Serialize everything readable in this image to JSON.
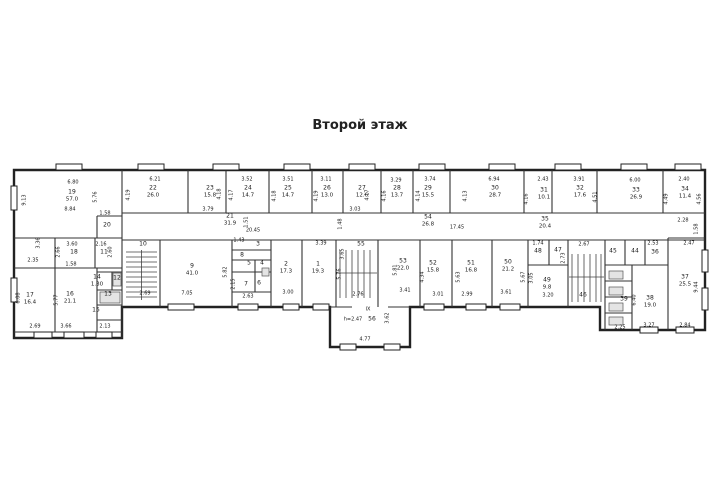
{
  "title": "Второй этаж",
  "plan": {
    "rooms": [
      {
        "id": "19",
        "area": "57.0",
        "x": 72,
        "y": 196
      },
      {
        "id": "20",
        "x": 107,
        "y": 226
      },
      {
        "id": "22",
        "area": "26.0",
        "x": 153,
        "y": 192
      },
      {
        "id": "23",
        "area": "15.8",
        "x": 210,
        "y": 192
      },
      {
        "id": "24",
        "area": "14.7",
        "x": 248,
        "y": 192
      },
      {
        "id": "25",
        "area": "14.7",
        "x": 288,
        "y": 192
      },
      {
        "id": "26",
        "area": "13.0",
        "x": 327,
        "y": 192
      },
      {
        "id": "27",
        "area": "12.6",
        "x": 362,
        "y": 192
      },
      {
        "id": "28",
        "area": "13.7",
        "x": 397,
        "y": 192
      },
      {
        "id": "29",
        "area": "15.5",
        "x": 428,
        "y": 192
      },
      {
        "id": "30",
        "area": "28.7",
        "x": 495,
        "y": 192
      },
      {
        "id": "31",
        "area": "10.1",
        "x": 544,
        "y": 194
      },
      {
        "id": "32",
        "area": "17.6",
        "x": 580,
        "y": 192
      },
      {
        "id": "33",
        "area": "26.9",
        "x": 636,
        "y": 194
      },
      {
        "id": "34",
        "area": "11.4",
        "x": 685,
        "y": 193
      },
      {
        "id": "21",
        "area": "31.9",
        "x": 230,
        "y": 220
      },
      {
        "id": "54",
        "area": "26.8",
        "x": 428,
        "y": 221
      },
      {
        "id": "35",
        "area": "20.4",
        "x": 545,
        "y": 223
      },
      {
        "id": "18",
        "x": 74,
        "y": 253
      },
      {
        "id": "11",
        "x": 104,
        "y": 253
      },
      {
        "id": "17",
        "area": "16.4",
        "x": 30,
        "y": 299
      },
      {
        "id": "16",
        "area": "21.1",
        "x": 70,
        "y": 298
      },
      {
        "id": "14",
        "area": "1.30",
        "x": 97,
        "y": 281
      },
      {
        "id": "12",
        "x": 117,
        "y": 279
      },
      {
        "id": "13",
        "x": 108,
        "y": 295
      },
      {
        "id": "15",
        "x": 96,
        "y": 311
      },
      {
        "id": "10",
        "x": 143,
        "y": 245
      },
      {
        "id": "9",
        "area": "41.0",
        "x": 192,
        "y": 270
      },
      {
        "id": "3",
        "x": 258,
        "y": 245
      },
      {
        "id": "8",
        "x": 242,
        "y": 256
      },
      {
        "id": "5",
        "x": 249,
        "y": 264
      },
      {
        "id": "4",
        "x": 262,
        "y": 264
      },
      {
        "id": "7",
        "x": 246,
        "y": 285
      },
      {
        "id": "6",
        "x": 259,
        "y": 284
      },
      {
        "id": "2",
        "area": "17.3",
        "x": 286,
        "y": 268
      },
      {
        "id": "1",
        "area": "19.3",
        "x": 318,
        "y": 268
      },
      {
        "id": "55",
        "x": 361,
        "y": 245
      },
      {
        "id": "53",
        "area": "22.0",
        "x": 403,
        "y": 265
      },
      {
        "id": "52",
        "area": "15.8",
        "x": 433,
        "y": 267
      },
      {
        "id": "51",
        "area": "16.8",
        "x": 471,
        "y": 267
      },
      {
        "id": "50",
        "area": "21.2",
        "x": 508,
        "y": 266
      },
      {
        "id": "48",
        "x": 538,
        "y": 252
      },
      {
        "id": "47",
        "x": 558,
        "y": 251
      },
      {
        "id": "49",
        "area": "9.8",
        "x": 547,
        "y": 284
      },
      {
        "id": "46",
        "x": 583,
        "y": 296
      },
      {
        "id": "45",
        "x": 613,
        "y": 252
      },
      {
        "id": "44",
        "x": 635,
        "y": 252
      },
      {
        "id": "36",
        "x": 655,
        "y": 253
      },
      {
        "id": "39",
        "x": 624,
        "y": 300
      },
      {
        "id": "38",
        "area": "19.0",
        "x": 650,
        "y": 302
      },
      {
        "id": "37",
        "area": "25.5",
        "x": 685,
        "y": 281
      },
      {
        "id": "56",
        "x": 372,
        "y": 320
      }
    ],
    "dims": [
      {
        "t": "6.80",
        "x": 73,
        "y": 183
      },
      {
        "t": "8.84",
        "x": 70,
        "y": 210
      },
      {
        "t": "9.13",
        "x": 25,
        "y": 200,
        "r": 1
      },
      {
        "t": "5.76",
        "x": 96,
        "y": 197,
        "r": 1
      },
      {
        "t": "1.58",
        "x": 105,
        "y": 214
      },
      {
        "t": "3.60",
        "x": 72,
        "y": 245
      },
      {
        "t": "2.16",
        "x": 101,
        "y": 245
      },
      {
        "t": "2.66",
        "x": 59,
        "y": 252,
        "r": 1
      },
      {
        "t": "2.60",
        "x": 111,
        "y": 252,
        "r": 1
      },
      {
        "t": "1.58",
        "x": 71,
        "y": 265
      },
      {
        "t": "3.36",
        "x": 39,
        "y": 243,
        "r": 1
      },
      {
        "t": "2.35",
        "x": 33,
        "y": 261
      },
      {
        "t": "6.08",
        "x": 19,
        "y": 298,
        "r": 1
      },
      {
        "t": "5.77",
        "x": 57,
        "y": 300,
        "r": 1
      },
      {
        "t": "2.69",
        "x": 35,
        "y": 327
      },
      {
        "t": "3.66",
        "x": 66,
        "y": 327
      },
      {
        "t": "2.13",
        "x": 105,
        "y": 327
      },
      {
        "t": "6.21",
        "x": 155,
        "y": 180
      },
      {
        "t": "4.19",
        "x": 129,
        "y": 195,
        "r": 1
      },
      {
        "t": "3.52",
        "x": 247,
        "y": 180
      },
      {
        "t": "3.51",
        "x": 288,
        "y": 180
      },
      {
        "t": "3.11",
        "x": 326,
        "y": 180
      },
      {
        "t": "3.29",
        "x": 396,
        "y": 181
      },
      {
        "t": "3.74",
        "x": 430,
        "y": 180
      },
      {
        "t": "6.94",
        "x": 494,
        "y": 180
      },
      {
        "t": "2.43",
        "x": 543,
        "y": 180
      },
      {
        "t": "3.91",
        "x": 579,
        "y": 180
      },
      {
        "t": "6.00",
        "x": 635,
        "y": 181
      },
      {
        "t": "2.40",
        "x": 684,
        "y": 180
      },
      {
        "t": "4.18",
        "x": 220,
        "y": 194,
        "r": 1
      },
      {
        "t": "4.17",
        "x": 232,
        "y": 195,
        "r": 1
      },
      {
        "t": "4.18",
        "x": 275,
        "y": 196,
        "r": 1
      },
      {
        "t": "4.19",
        "x": 317,
        "y": 196,
        "r": 1
      },
      {
        "t": "4.17",
        "x": 368,
        "y": 195,
        "r": 1
      },
      {
        "t": "4.16",
        "x": 385,
        "y": 196,
        "r": 1
      },
      {
        "t": "4.14",
        "x": 419,
        "y": 196,
        "r": 1
      },
      {
        "t": "4.13",
        "x": 466,
        "y": 196,
        "r": 1
      },
      {
        "t": "4.16",
        "x": 527,
        "y": 199,
        "r": 1
      },
      {
        "t": "4.51",
        "x": 596,
        "y": 197,
        "r": 1
      },
      {
        "t": "4.49",
        "x": 667,
        "y": 199,
        "r": 1
      },
      {
        "t": "4.56",
        "x": 700,
        "y": 199,
        "r": 1
      },
      {
        "t": "3.79",
        "x": 208,
        "y": 210
      },
      {
        "t": "3.03",
        "x": 355,
        "y": 210
      },
      {
        "t": "1.48",
        "x": 341,
        "y": 224,
        "r": 1
      },
      {
        "t": "1.51",
        "x": 247,
        "y": 222,
        "r": 1
      },
      {
        "t": "20.45",
        "x": 253,
        "y": 231
      },
      {
        "t": "17.45",
        "x": 457,
        "y": 228
      },
      {
        "t": "2.28",
        "x": 683,
        "y": 221
      },
      {
        "t": "1.58",
        "x": 697,
        "y": 229,
        "r": 1
      },
      {
        "t": "1.43",
        "x": 239,
        "y": 241
      },
      {
        "t": "2.69",
        "x": 145,
        "y": 294
      },
      {
        "t": "7.05",
        "x": 187,
        "y": 294
      },
      {
        "t": "5.82",
        "x": 226,
        "y": 272,
        "r": 1
      },
      {
        "t": "2.15",
        "x": 234,
        "y": 284,
        "r": 1
      },
      {
        "t": "2.63",
        "x": 248,
        "y": 297
      },
      {
        "t": "3.00",
        "x": 288,
        "y": 293
      },
      {
        "t": "3.39",
        "x": 321,
        "y": 244
      },
      {
        "t": "5.76",
        "x": 340,
        "y": 274,
        "r": 1
      },
      {
        "t": "3.65",
        "x": 343,
        "y": 254,
        "r": 1
      },
      {
        "t": "2.76",
        "x": 358,
        "y": 295
      },
      {
        "t": "5.81",
        "x": 396,
        "y": 270,
        "r": 1
      },
      {
        "t": "3.41",
        "x": 405,
        "y": 291
      },
      {
        "t": "4.34",
        "x": 423,
        "y": 277,
        "r": 1
      },
      {
        "t": "3.01",
        "x": 438,
        "y": 295
      },
      {
        "t": "5.63",
        "x": 459,
        "y": 277,
        "r": 1
      },
      {
        "t": "2.99",
        "x": 467,
        "y": 295
      },
      {
        "t": "5.67",
        "x": 524,
        "y": 277,
        "r": 1
      },
      {
        "t": "3.61",
        "x": 506,
        "y": 293
      },
      {
        "t": "3.05",
        "x": 532,
        "y": 278,
        "r": 1
      },
      {
        "t": "1.74",
        "x": 538,
        "y": 244
      },
      {
        "t": "2.73",
        "x": 564,
        "y": 258,
        "r": 1
      },
      {
        "t": "3.20",
        "x": 548,
        "y": 296
      },
      {
        "t": "2.67",
        "x": 584,
        "y": 245
      },
      {
        "t": "2.53",
        "x": 653,
        "y": 244
      },
      {
        "t": "2.47",
        "x": 689,
        "y": 244
      },
      {
        "t": "9.44",
        "x": 697,
        "y": 287,
        "r": 1
      },
      {
        "t": "6.40",
        "x": 635,
        "y": 300,
        "r": 1
      },
      {
        "t": "3.27",
        "x": 649,
        "y": 326
      },
      {
        "t": "2.84",
        "x": 685,
        "y": 326
      },
      {
        "t": "2.25",
        "x": 620,
        "y": 328
      },
      {
        "t": "h=2.47",
        "x": 353,
        "y": 320
      },
      {
        "t": "3.62",
        "x": 388,
        "y": 318,
        "r": 1
      },
      {
        "t": "4.77",
        "x": 365,
        "y": 340
      },
      {
        "t": "IX",
        "x": 368,
        "y": 310
      }
    ]
  }
}
